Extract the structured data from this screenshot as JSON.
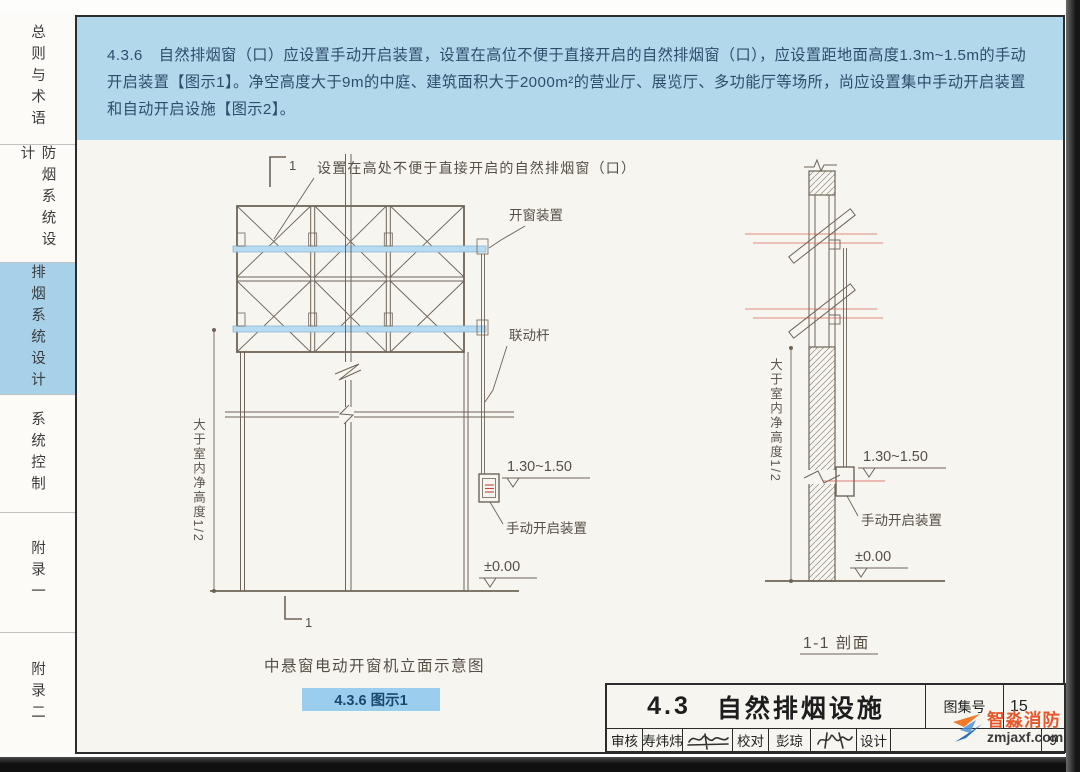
{
  "sidebar": {
    "tabs": [
      {
        "label": "总则与术语",
        "active": false
      },
      {
        "label": "防烟系统设计",
        "active": false
      },
      {
        "label": "排烟系统设计",
        "active": true
      },
      {
        "label": "系统控制",
        "active": false
      },
      {
        "label": "附录一",
        "active": false
      },
      {
        "label": "附录二",
        "active": false
      }
    ]
  },
  "header": {
    "clause_no": "4.3.6",
    "body": "自然排烟窗（口）应设置手动开启装置，设置在高位不便于直接开启的自然排烟窗（口），应设置距地面高度1.3m~1.5m的手动开启装置【图示1】。净空高度大于9m的中庭、建筑面积大于2000m²的营业厅、展览厅、多功能厅等场所，尚应设置集中手动开启装置和自动开启设施【图示2】。"
  },
  "figure1": {
    "marker_top": "1",
    "marker_bottom": "1",
    "window_label": "设置在高处不便于直接开启的自然排烟窗（口）",
    "opener_label": "开窗装置",
    "linkrod_label": "联动杆",
    "manual_label": "手动开启装置",
    "dim_height": "大于室内净高度1/2",
    "level_handle": "1.30~1.50",
    "level_ground": "±0.00",
    "caption": "中悬窗电动开窗机立面示意图",
    "badge": "4.3.6 图示1"
  },
  "figure2": {
    "manual_label": "手动开启装置",
    "dim_height": "大于室内净高度1/2",
    "level_handle": "1.30~1.50",
    "level_ground": "±0.00",
    "caption": "1-1 剖面"
  },
  "titleblock": {
    "section_no": "4.3",
    "title": "自然排烟设施",
    "atlas_label": "图集号",
    "atlas_no": "15",
    "reviewer_label": "审核",
    "reviewer": "寿炜炜",
    "proof_label": "校对",
    "proofreader": "彭琼",
    "designer_label": "设计",
    "page_no": "9"
  },
  "watermark": {
    "name": "智淼消防",
    "site": "zmjaxf.com"
  }
}
